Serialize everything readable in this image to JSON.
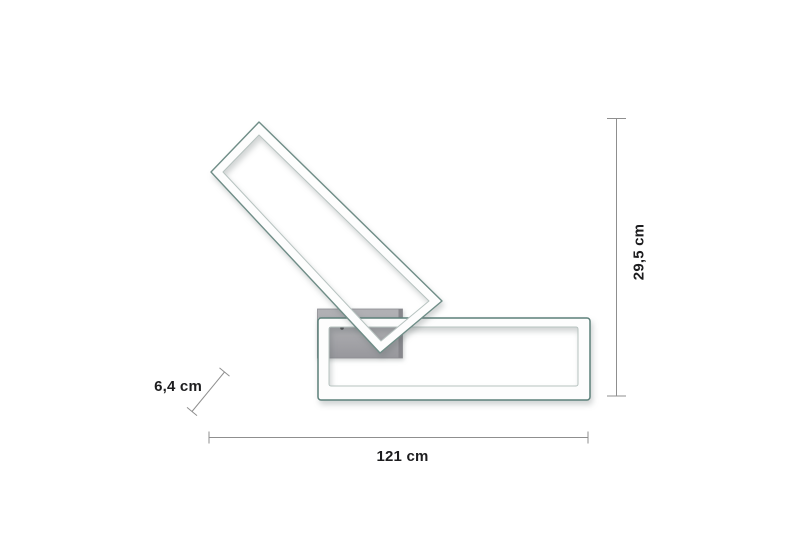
{
  "dimensions": {
    "width_label": "121 cm",
    "height_label": "29,5 cm",
    "depth_label": "6,4 cm"
  },
  "colors": {
    "background": "#ffffff",
    "dimension-line": "#8f8f8f",
    "label-text": "#1d1d1f",
    "frame-outer-edge": "#6f8d87",
    "frame-outer-edge-strong": "#5d807a",
    "frame-inner-edge": "#b7c3c0",
    "frame-band": "#fdfdfd",
    "plate-gray": "#a7a7ab",
    "plate-gray-dark": "#97979c",
    "plate-edge": "#8d8d92",
    "screw-dot": "#4a4a4e"
  }
}
